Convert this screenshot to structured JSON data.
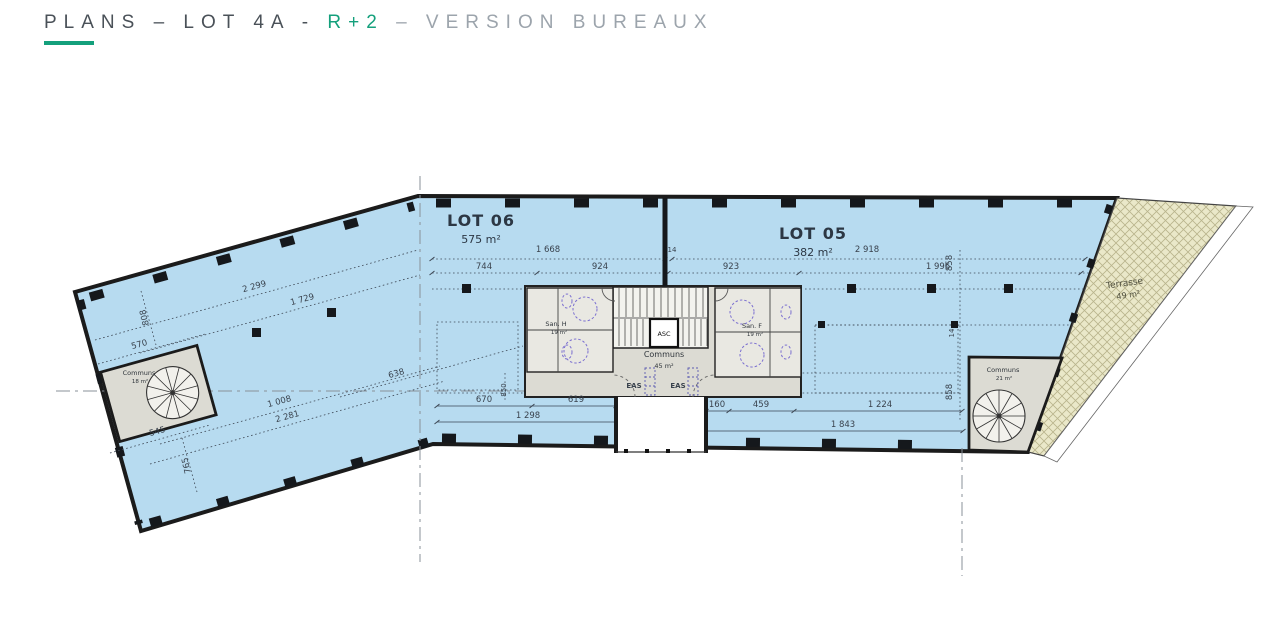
{
  "header": {
    "title_prefix": "PLANS – LOT 4A - ",
    "title_floor": "R+2",
    "title_suffix": " – VERSION BUREAUX",
    "accent_color": "#14A07C"
  },
  "plan": {
    "lot06": {
      "name": "LOT 06",
      "area": "575 m²"
    },
    "lot05": {
      "name": "LOT 05",
      "area": "382 m²"
    },
    "core": {
      "communs_label": "Communs",
      "communs_area": "45 m²",
      "elevator_label": "ASC",
      "san_h_label": "San. H",
      "san_h_area": "19 m²",
      "san_f_label": "San. F",
      "san_f_area": "19 m²",
      "eas_left": "EAS",
      "eas_right": "EAS"
    },
    "stair_left": {
      "label": "Communs",
      "area": "18 m²"
    },
    "stair_right": {
      "label": "Communs",
      "area": "21 m²"
    },
    "terrace": {
      "label": "Terrasse",
      "area": "49 m²"
    },
    "dimensions": {
      "top": {
        "d1668": "1 668",
        "d14": "14",
        "d744": "744",
        "d924": "924",
        "d923": "923",
        "d2918": "2 918",
        "d1996": "1 996",
        "d858_upper": "858",
        "d14_mid": "14",
        "d858_lower": "858"
      },
      "left": {
        "d2299": "2 299",
        "d1729": "1 729",
        "d808": "808",
        "d570": "570",
        "d638": "638",
        "d1008": "1 008",
        "d2281": "2 281",
        "d545": "545",
        "d765": "765"
      },
      "bottom": {
        "d670": "670",
        "d619": "619",
        "d1298": "1 298",
        "d850": "850",
        "d160": "160",
        "d459": "459",
        "d1224": "1 224",
        "d1843": "1 843"
      }
    },
    "colors": {
      "floor": "#B7DBF0",
      "core": "#DCDBD3",
      "terrace": "#EAE8C9",
      "wall": "#1B1B1B",
      "fixture": "#7B6FD0",
      "eas_text": "#2FA8DC"
    }
  }
}
